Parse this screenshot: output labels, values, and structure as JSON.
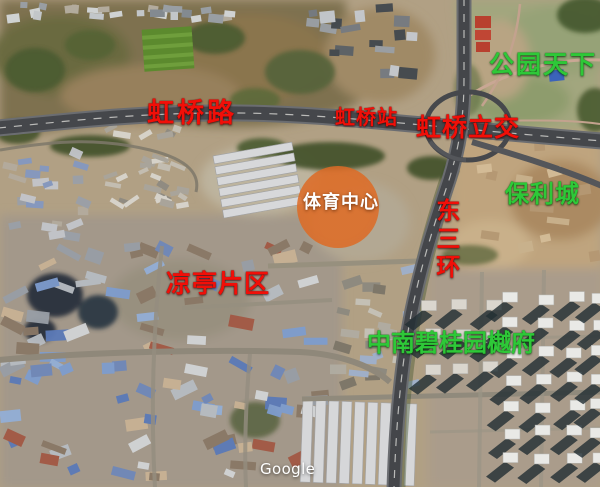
{
  "image_type": "annotated-satellite-map",
  "colors": {
    "label_red": "#f10f08",
    "label_green": "#2ec838",
    "label_white": "#ffffff",
    "highlight_orange": "#de6c26"
  },
  "map": {
    "labels": [
      {
        "id": "hongqiao-road",
        "text": "虹桥路",
        "color": "red"
      },
      {
        "id": "hongqiao-station",
        "text": "虹桥站",
        "color": "red"
      },
      {
        "id": "hongqiao-interchange",
        "text": "虹桥立交",
        "color": "red"
      },
      {
        "id": "park-tianxia",
        "text": "公园天下",
        "color": "green"
      },
      {
        "id": "poly-city",
        "text": "保利城",
        "color": "green"
      },
      {
        "id": "sports-center",
        "text": "体育中心",
        "color": "white"
      },
      {
        "id": "liangting-area",
        "text": "凉亭片区",
        "color": "red"
      },
      {
        "id": "east-third-ring",
        "text": "东三环",
        "color": "red",
        "orientation": "vertical"
      },
      {
        "id": "zhongnan-biguiyuan-yuefu",
        "text": "中南碧桂园樾府",
        "color": "green"
      }
    ],
    "watermark": "Google"
  }
}
